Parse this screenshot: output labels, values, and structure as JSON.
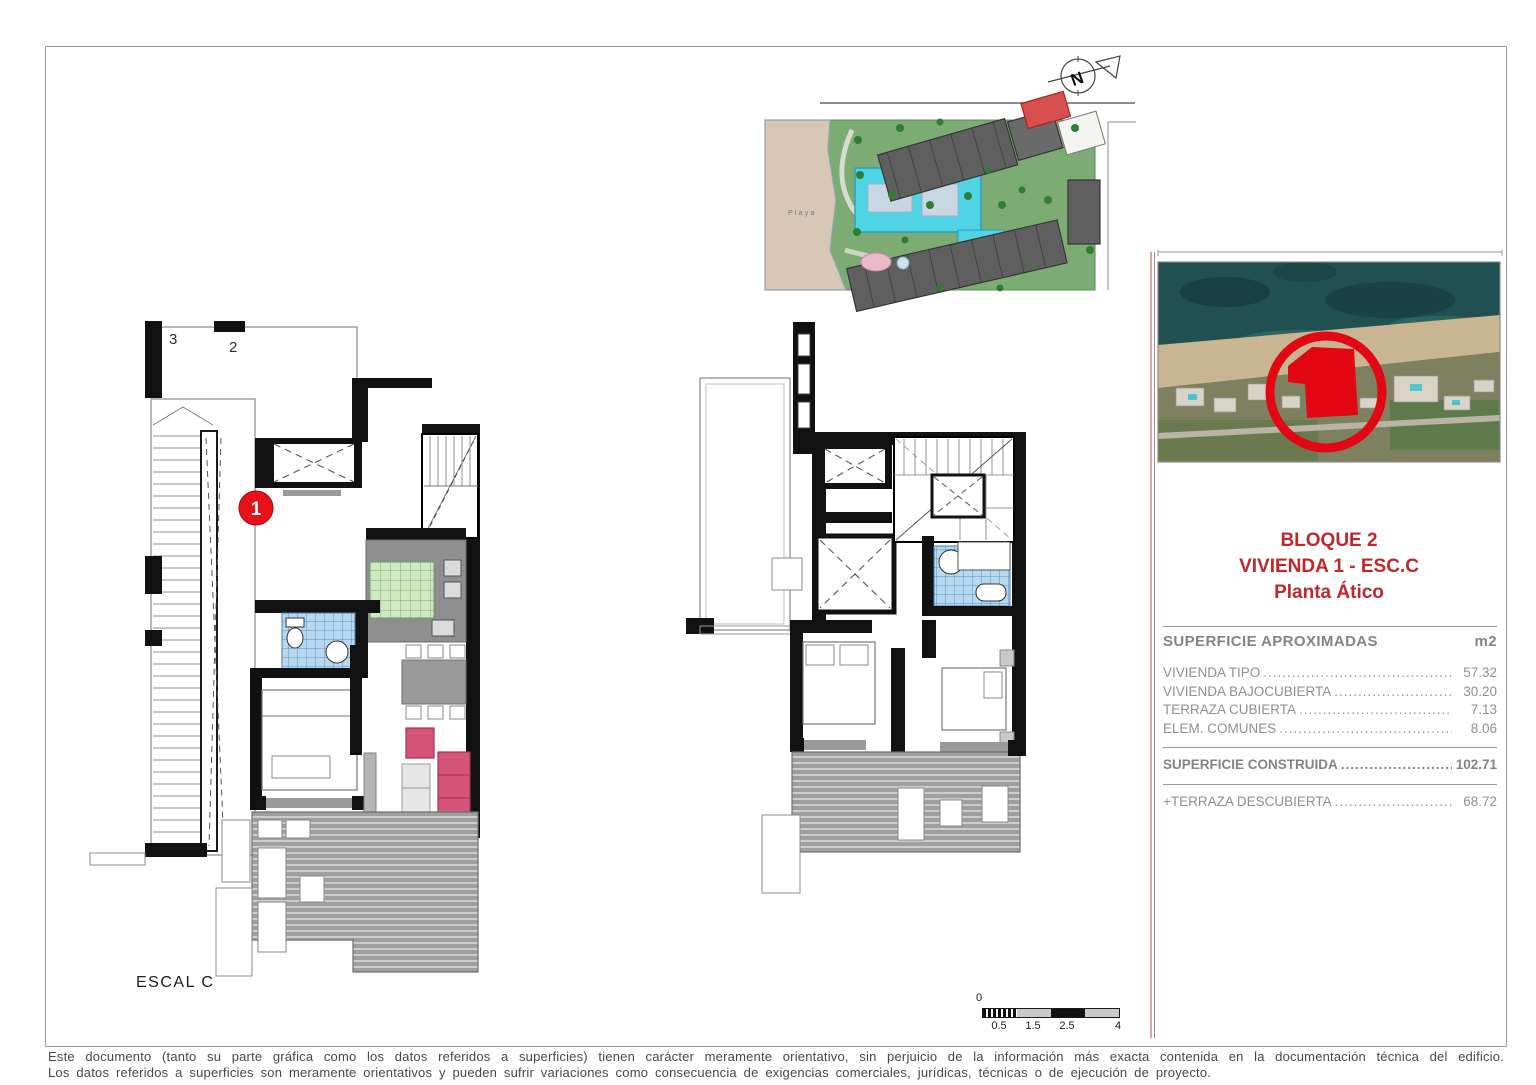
{
  "site_plan": {
    "playa_label": "Playa",
    "north_label": "N"
  },
  "left_plan": {
    "title": "ESCAL C",
    "unit_label_3": "3",
    "unit_label_2": "2",
    "marker": "1"
  },
  "panel": {
    "title_line1": "BLOQUE 2",
    "title_line2": "VIVIENDA 1 - ESC.C",
    "title_line3": "Planta Ático",
    "table_header": "SUPERFICIE APROXIMADAS",
    "table_unit": "m2",
    "rows": [
      {
        "label": "VIVIENDA TIPO",
        "value": "57.32"
      },
      {
        "label": "VIVIENDA BAJOCUBIERTA",
        "value": "30.20"
      },
      {
        "label": "TERRAZA CUBIERTA",
        "value": "7.13"
      },
      {
        "label": "ELEM. COMUNES",
        "value": "8.06"
      }
    ],
    "total_label": "SUPERFICIE CONSTRUIDA",
    "total_value": "102.71",
    "extra_label": "+TERRAZA DESCUBIERTA",
    "extra_value": "68.72"
  },
  "scale_bar": {
    "zero": "0",
    "ticks": [
      "0.5",
      "1.5",
      "2.5",
      "4"
    ]
  },
  "disclaimer": {
    "line1": "Este documento (tanto su parte gráfica como los datos referidos a superficies) tienen carácter meramente orientativo, sin perjuicio de la información más exacta contenida en la documentación técnica del edificio.",
    "line2": "Los datos referidos a superficies son meramente orientativos y pueden sufrir variaciones como consecuencia de exigencias comerciales, jurídicas, técnicas o de ejecución de proyecto."
  },
  "colors": {
    "accent_red": "#c0272d",
    "marker_red": "#e8111a",
    "highlight_red": "#e30613",
    "pool_cyan": "#4fd4e6",
    "garden_green": "#7cab74",
    "beach_tan": "#d9c7b6",
    "wall_black": "#111111",
    "terrace_gray": "#a0a0a0",
    "text_gray": "#8f8f8f"
  }
}
